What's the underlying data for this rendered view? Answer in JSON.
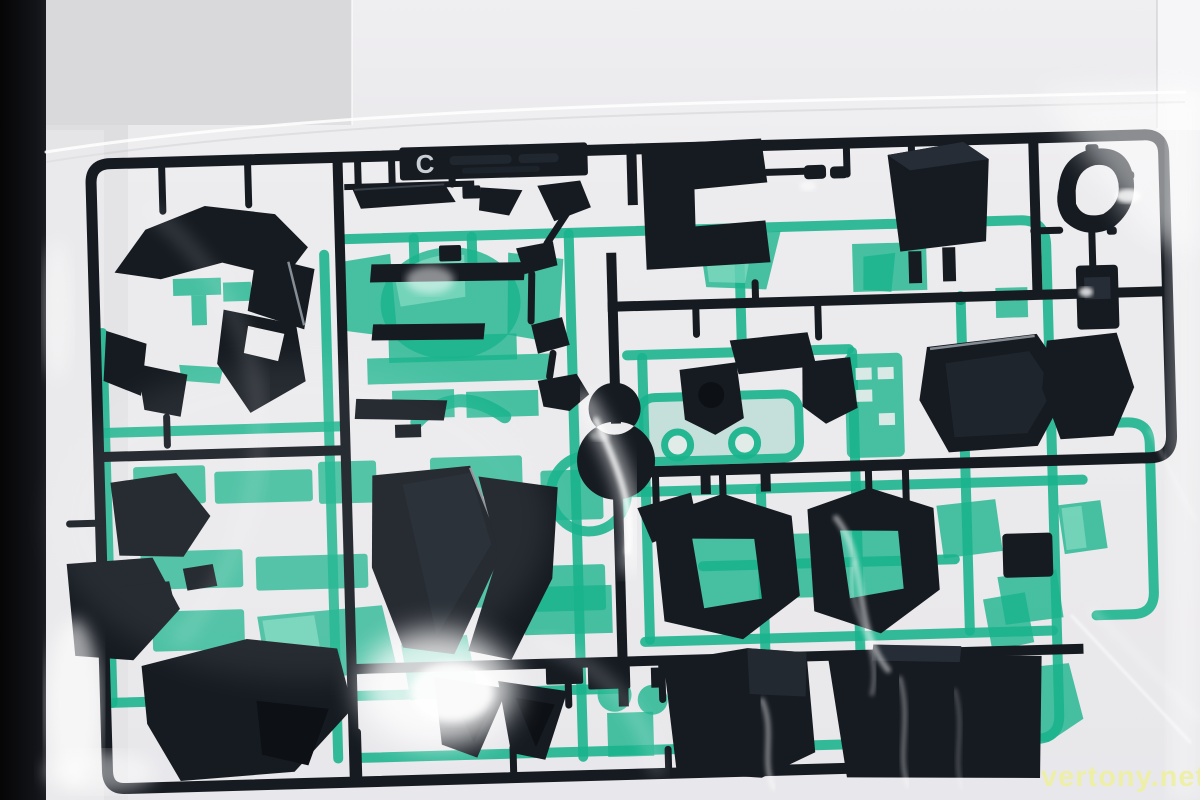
{
  "photo": {
    "description": "Plastic model kit sprue runner with dark navy and translucent green parts sealed in a clear plastic bag, photographed on a white surface",
    "runner_tag_letter": "C",
    "watermark_text": "vertony.net"
  },
  "colors": {
    "backdrop": "#e8e7ea",
    "backdrop_left": "#d8d7da",
    "backdrop_bright": "#f6f5f7",
    "table_edge": "#0a0a0b",
    "dark_plastic": "#161b22",
    "dark_plastic_hi": "#262d36",
    "green_plastic": "#18b38c",
    "green_deep": "#0d8a6b",
    "green_light": "#9fe8d2",
    "tag_letter": "#c9ced4",
    "watermark": "#eef0a2"
  }
}
